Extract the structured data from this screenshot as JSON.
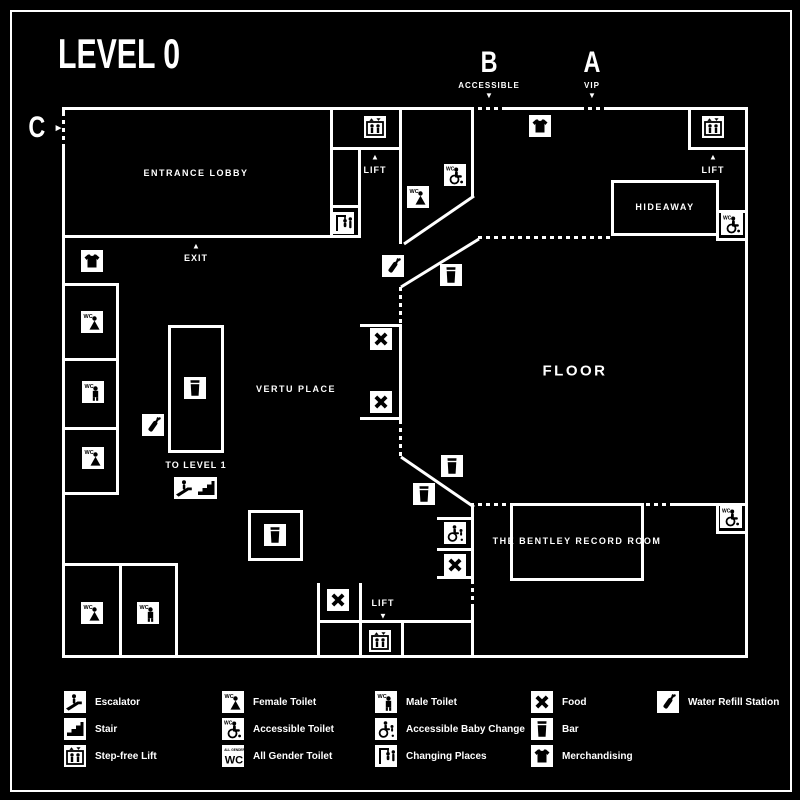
{
  "title": "LEVEL 0",
  "colors": {
    "background": "#000000",
    "foreground": "#ffffff"
  },
  "entrances": {
    "b": {
      "letter": "B",
      "sublabel": "ACCESSIBLE",
      "arrow": "▼"
    },
    "a": {
      "letter": "A",
      "sublabel": "VIP",
      "arrow": "▼"
    },
    "c": {
      "letter": "C",
      "arrow": "►"
    }
  },
  "rooms": {
    "entrance_lobby": "ENTRANCE LOBBY",
    "hideaway": "HIDEAWAY",
    "floor": "FLOOR",
    "vertu_place": "VERTU PLACE",
    "bentley_record_room": "THE BENTLEY RECORD ROOM"
  },
  "wayfinding": {
    "exit": "EXIT",
    "to_level_1": "TO LEVEL 1",
    "lift_west": "LIFT",
    "lift_east": "LIFT",
    "lift_south": "LIFT",
    "exit_arrow": "▲",
    "lift_west_arrow": "▲",
    "lift_east_arrow": "▲",
    "lift_south_arrow": "▼"
  },
  "map_icons": [
    {
      "type": "stepfree-lift",
      "x": 375,
      "y": 127
    },
    {
      "type": "stepfree-lift",
      "x": 713,
      "y": 127
    },
    {
      "type": "stepfree-lift",
      "x": 380,
      "y": 641
    },
    {
      "type": "merchandising",
      "x": 540,
      "y": 126
    },
    {
      "type": "merchandising",
      "x": 92,
      "y": 261
    },
    {
      "type": "changing-places",
      "x": 343,
      "y": 223
    },
    {
      "type": "female-toilet",
      "x": 418,
      "y": 197
    },
    {
      "type": "female-toilet",
      "x": 92,
      "y": 322
    },
    {
      "type": "female-toilet",
      "x": 93,
      "y": 458
    },
    {
      "type": "female-toilet",
      "x": 92,
      "y": 613
    },
    {
      "type": "male-toilet",
      "x": 93,
      "y": 392
    },
    {
      "type": "male-toilet",
      "x": 148,
      "y": 613
    },
    {
      "type": "accessible-toilet",
      "x": 455,
      "y": 175
    },
    {
      "type": "accessible-toilet",
      "x": 732,
      "y": 224
    },
    {
      "type": "accessible-toilet",
      "x": 731,
      "y": 517
    },
    {
      "type": "bar",
      "x": 195,
      "y": 388
    },
    {
      "type": "bar",
      "x": 451,
      "y": 275
    },
    {
      "type": "bar",
      "x": 452,
      "y": 466
    },
    {
      "type": "bar",
      "x": 424,
      "y": 494
    },
    {
      "type": "bar",
      "x": 275,
      "y": 535
    },
    {
      "type": "water-refill",
      "x": 153,
      "y": 425
    },
    {
      "type": "water-refill",
      "x": 393,
      "y": 266
    },
    {
      "type": "food",
      "x": 381,
      "y": 339
    },
    {
      "type": "food",
      "x": 381,
      "y": 402
    },
    {
      "type": "food",
      "x": 338,
      "y": 600
    },
    {
      "type": "food",
      "x": 455,
      "y": 565
    },
    {
      "type": "baby-change",
      "x": 455,
      "y": 533
    },
    {
      "type": "escalator",
      "x": 185,
      "y": 488
    },
    {
      "type": "stair",
      "x": 206,
      "y": 488
    }
  ],
  "legend": [
    {
      "icon": "escalator",
      "label": "Escalator"
    },
    {
      "icon": "stair",
      "label": "Stair"
    },
    {
      "icon": "stepfree-lift",
      "label": "Step-free Lift"
    },
    {
      "icon": "female-toilet",
      "label": "Female Toilet"
    },
    {
      "icon": "accessible-toilet",
      "label": "Accessible Toilet"
    },
    {
      "icon": "allgender-toilet",
      "label": "All Gender Toilet"
    },
    {
      "icon": "male-toilet",
      "label": "Male Toilet"
    },
    {
      "icon": "baby-change",
      "label": "Accessible Baby Change"
    },
    {
      "icon": "changing-places",
      "label": "Changing Places"
    },
    {
      "icon": "food",
      "label": "Food"
    },
    {
      "icon": "bar",
      "label": "Bar"
    },
    {
      "icon": "merchandising",
      "label": "Merchandising"
    },
    {
      "icon": "water-refill",
      "label": "Water Refill Station"
    }
  ]
}
